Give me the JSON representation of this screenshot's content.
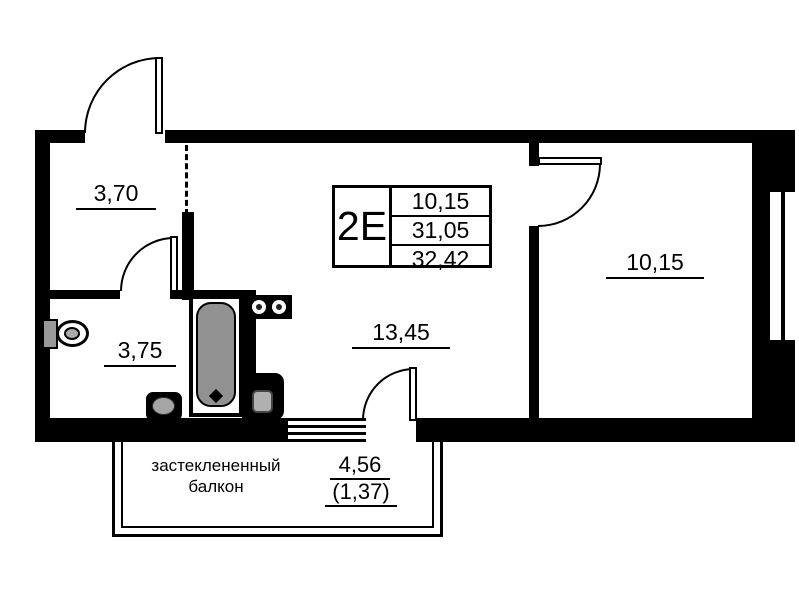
{
  "plan": {
    "legend": {
      "unit_type": "2E",
      "values": [
        "10,15",
        "31,05",
        "32,42"
      ]
    },
    "rooms": {
      "hallway_area": "3,70",
      "bathroom_area": "3,75",
      "living_area": "13,45",
      "bedroom_area": "10,15"
    },
    "balcony": {
      "name_line1": "застеклененный",
      "name_line2": "балкон",
      "area": "4,56",
      "area_secondary": "(1,37)"
    },
    "colors": {
      "wall": "#000000",
      "background": "#ffffff",
      "fixture_gray": "#919191"
    }
  }
}
